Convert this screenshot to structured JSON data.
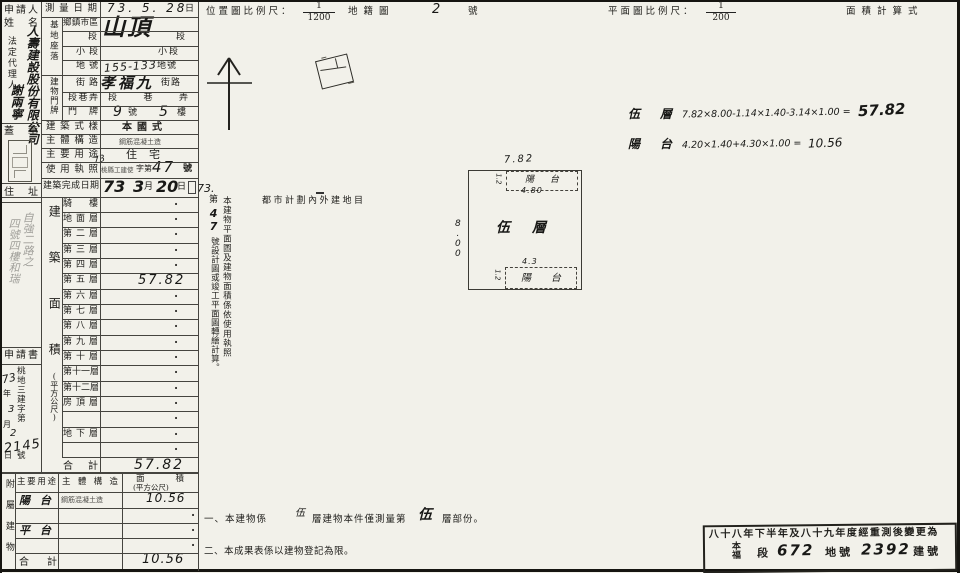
{
  "header": {
    "loc_scale_label": "位置圖比例尺：",
    "loc_scale_num": "1",
    "loc_scale_den": "1200",
    "cadastral_label": "地籍圖",
    "cadastral_no": "2",
    "cadastral_suffix": "號",
    "plan_scale_label": "平面圖比例尺：",
    "plan_scale_num": "1",
    "plan_scale_den": "200",
    "area_calc_label": "面積計算式"
  },
  "applicant": {
    "label1": "申請人",
    "label2": "姓名",
    "agent_label": "法定代理人",
    "company": "人壽建設股份有限公司",
    "agent_name": "謝兩寧",
    "seal_label": "蓋章",
    "address_label": "住址",
    "address_hand1": "自強二路之",
    "address_hand2": "四號四樓和瑞"
  },
  "fields": {
    "survey_date": {
      "label": "測量日期",
      "value": "73. 5. 28",
      "suffix": "日"
    },
    "site_group": "基地座落",
    "township": {
      "label": "鄉鎮市區",
      "value": "山頂"
    },
    "section": {
      "label": "段",
      "suffix": "段"
    },
    "subsection": {
      "label": "小段",
      "suffix": "小段"
    },
    "lot": {
      "label": "地號",
      "value": "155-133",
      "suffix": "地號"
    },
    "door_group": "建物門牌",
    "street": {
      "label": "街路",
      "value": "孝福九",
      "suffix": "街路"
    },
    "lane": {
      "label": "段巷弄",
      "value": "段巷弄"
    },
    "door": {
      "label": "門牌",
      "v1": "9",
      "s1": "號",
      "v2": "5",
      "s2": "樓"
    },
    "style": {
      "label": "建築式樣",
      "value": "本國式"
    },
    "structure": {
      "label": "主體構造",
      "value": "鋼筋混凝土造"
    },
    "usage": {
      "label": "主要用途",
      "value": "住宅"
    },
    "license": {
      "label": "使用執照",
      "hand_pre": "73",
      "small": "桃縣工建使",
      "mid": "字第",
      "no": "47",
      "suffix": "號"
    },
    "completion": {
      "label": "建築完成日期",
      "y": "73",
      "m": "3",
      "m_unit": "月",
      "d": "20",
      "d_unit": "日"
    }
  },
  "floor_table": {
    "group_label": "建築面積",
    "group_unit": "(平方公尺)",
    "rows": [
      {
        "label": "騎樓",
        "value": "·"
      },
      {
        "label": "地面層",
        "value": "·"
      },
      {
        "label": "第二層",
        "value": "·"
      },
      {
        "label": "第三層",
        "value": "·"
      },
      {
        "label": "第四層",
        "value": "·"
      },
      {
        "label": "第五層",
        "value": "57.82"
      },
      {
        "label": "第六層",
        "value": "·"
      },
      {
        "label": "第七層",
        "value": "·"
      },
      {
        "label": "第八層",
        "value": "·"
      },
      {
        "label": "第九層",
        "value": "·"
      },
      {
        "label": "第十層",
        "value": "·"
      },
      {
        "label": "第十一層",
        "value": "·"
      },
      {
        "label": "第十二層",
        "value": "·"
      },
      {
        "label": "房頂層",
        "value": "·"
      },
      {
        "label": "",
        "value": "·"
      },
      {
        "label": "地下層",
        "value": "·"
      },
      {
        "label": "",
        "value": "·"
      }
    ],
    "total_label": "合計",
    "total_value": "57.82"
  },
  "application": {
    "label": "申請書",
    "doc_prefix": "桃地三建字第",
    "year": "73",
    "year_unit": "年",
    "month": "3",
    "month_unit": "月",
    "day": "2",
    "day_unit": "日",
    "no": "2145",
    "no_unit": "號"
  },
  "attached_table": {
    "side_label": "附屬建物",
    "col_usage": "主要用途",
    "col_structure": "主體構造",
    "col_area1": "面積",
    "col_area2": "(平方公尺)",
    "row1": {
      "usage": "陽台",
      "structure": "鋼筋混凝土造",
      "area": "10.56"
    },
    "row2_dot": "·",
    "row3": {
      "usage": "平台",
      "dot": "·"
    },
    "row4_dot": "·",
    "total_label": "合計",
    "total_area": "10.56"
  },
  "site_map": {
    "hand_note": "73.",
    "note_col_right": "本建物平面圖及建物面積係依使用執照",
    "note_pre": "第",
    "note_no": "47",
    "note_post": "號設計圖或竣工平面圖轉繪計算。",
    "zoning_text": "都市計劃內外建地目"
  },
  "floor_plan": {
    "dim_top": "7.82",
    "dim_left": "8.00",
    "balcony_top_label": "陽台",
    "balcony_top_w": "4.80",
    "balcony_top_h": "1.2",
    "main_label": "伍層",
    "balcony_bottom_label": "陽台",
    "balcony_bottom_w": "4.3",
    "balcony_bottom_h": "1.2"
  },
  "calc": {
    "line1_label": "伍層",
    "line1_formula": "7.82×8.00-1.14×1.40-3.14×1.00 =",
    "line1_result": "57.82",
    "line2_label": "陽台",
    "line2_formula": "4.20×1.40+4.30×1.00 =",
    "line2_result": "10.56"
  },
  "notes": {
    "n1_pre": "一、本建物係",
    "n1_hand1": "伍",
    "n1_mid": "層建物本件僅測量第",
    "n1_hand2": "伍",
    "n1_post": "層部份。",
    "n2": "二、本成果表係以建物登記為限。"
  },
  "stamp": {
    "line1": "八十八年下半年及八十九年度經重測後變更為",
    "sec_name": "本福",
    "sec_unit": "段",
    "sec_no": "672",
    "lot_unit": "地號",
    "lot_no": "2392",
    "bld_unit": "建號"
  }
}
